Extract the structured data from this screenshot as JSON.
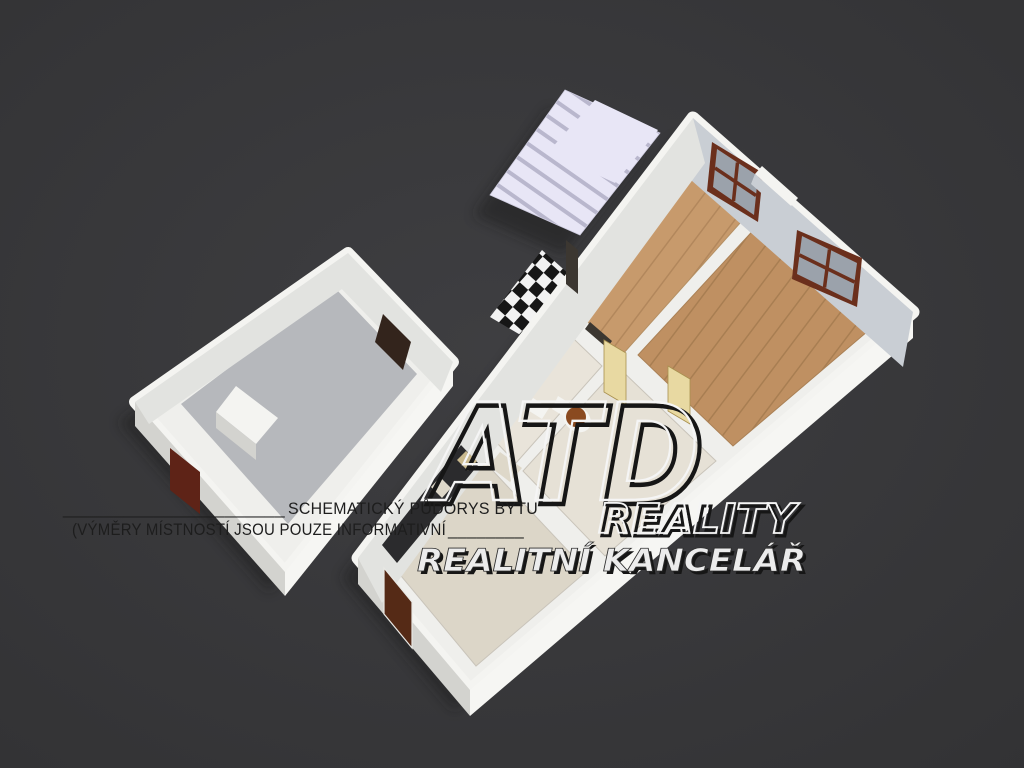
{
  "title": "Schematic 3D floor plan rendering",
  "colors": {
    "background": "#3a3a3c",
    "background_edge": "#303033",
    "shadow": "#1c1c1e",
    "wall": "#efefec",
    "wall_top": "#f4f4f1",
    "wall_face": "#c9ced4",
    "wall_face_light": "#e2e3e0",
    "wall_outer_bright": "#f6f6f3",
    "wall_outer_shade": "#d3d3cf",
    "floor_wood": "#c79a6c",
    "floor_wood_line": "#b2875c",
    "floor_wood2": "#bf9062",
    "floor_wood2_line": "#a87e52",
    "floor_bath": "#e9e4da",
    "floor_hall": "#e6e1d6",
    "floor_kitchen": "#dcd6c8",
    "floor_cellar": "#b6b8bc",
    "stairs": "#e8e6f6",
    "stairs_shade": "#b9b7cd",
    "checker_dark": "#161616",
    "checker_light": "#f2f2f2",
    "window_frame": "#6b2f1c",
    "window_glass": "#9ba2ab",
    "door_dark": "#552a16",
    "door_cellar": "#5e2317",
    "door_panel": "#e8d9a2",
    "door_panel_edge": "#a8904f",
    "counter": "#2b2b2d",
    "counter_item": "#c9b98e",
    "appliance": "#ded8c9",
    "toilet_lid": "#8a4a20",
    "green_item": "#2e9e3c",
    "opening": "#3c3731",
    "cellar_opening": "#33241c",
    "watermark_light": "#f5f5f5",
    "watermark_dark": "#161616",
    "disclaimer_text": "#1d1d1d"
  },
  "watermark": {
    "logo": "ATD",
    "brand": "REALITY",
    "subtitle": "REALITNÍ KANCELÁŘ"
  },
  "disclaimer": {
    "rule_left": "______________________",
    "title": "SCHEMATICKÝ PŮDORYS BYTU",
    "note": "(VÝMĚRY MÍSTNOSTÍ JSOU POUZE INFORMATIVNÍ",
    "rule_right": "________"
  }
}
